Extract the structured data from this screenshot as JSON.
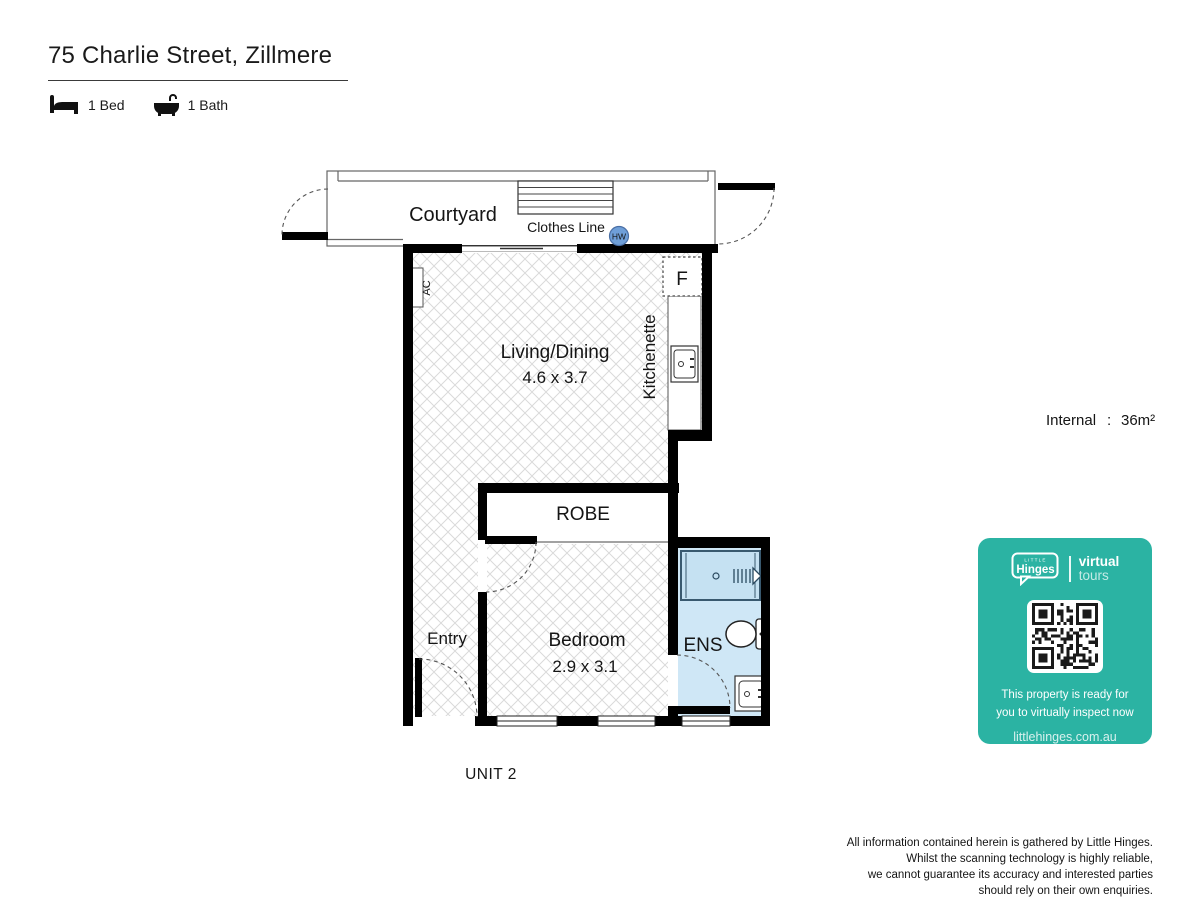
{
  "header": {
    "title": "75 Charlie Street, Zillmere",
    "bed_label": "1 Bed",
    "bath_label": "1 Bath"
  },
  "plan": {
    "unit_label": "UNIT 2",
    "rooms": {
      "courtyard": "Courtyard",
      "living": "Living/Dining",
      "living_dims": "4.6 x 3.7",
      "kitchenette": "Kitchenette",
      "robe": "ROBE",
      "entry": "Entry",
      "bedroom": "Bedroom",
      "bedroom_dims": "2.9 x 3.1",
      "ens": "ENS"
    },
    "labels": {
      "clothes_line": "Clothes Line",
      "hot_water": "HW",
      "air_con": "AC",
      "fridge": "F"
    }
  },
  "area": {
    "label": "Internal",
    "colon": ":",
    "value": "36m²"
  },
  "badge": {
    "brand_top": "LITTLE",
    "brand": "Hinges",
    "tagline_bold": "virtual",
    "tagline_light": "tours",
    "line1": "This property is ready for",
    "line2": "you to virtually inspect now",
    "url": "littlehinges.com.au",
    "accent_color": "#2bb3a3"
  },
  "footer": {
    "line1": "All information contained herein is gathered by Little Hinges.",
    "line2": "Whilst the scanning technology is highly reliable,",
    "line3": "we cannot guarantee its accuracy and interested parties",
    "line4": "should rely on their own enquiries."
  }
}
